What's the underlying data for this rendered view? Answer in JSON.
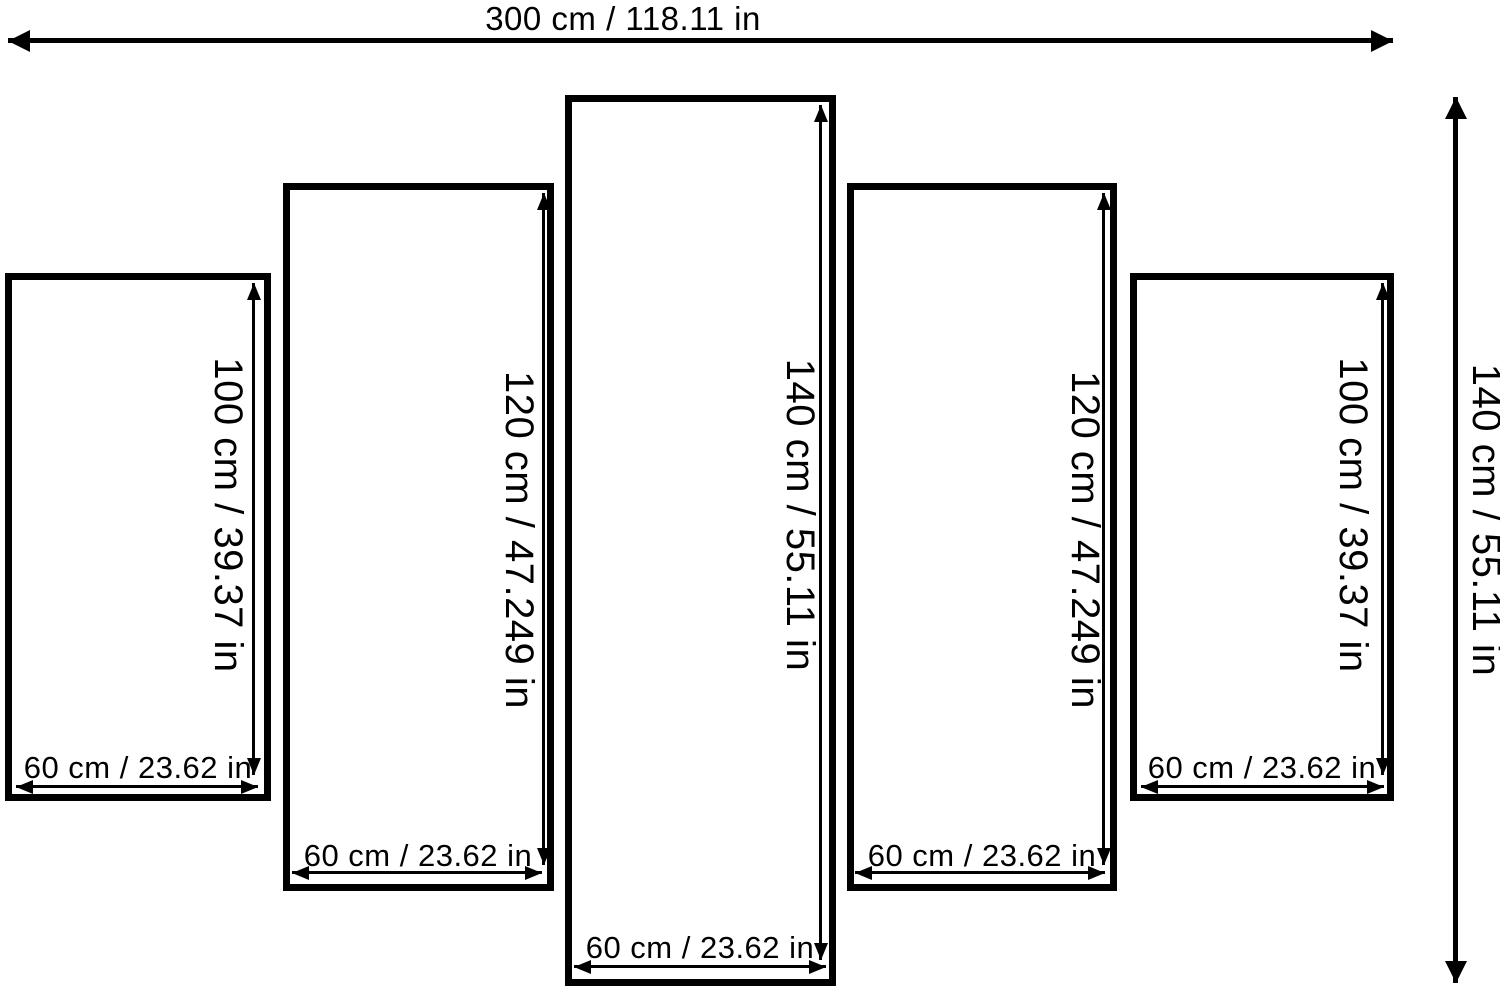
{
  "diagram": {
    "type": "five-panel canvas size diagram",
    "overall_width": {
      "label": "300 cm / 118.11 in",
      "cm": 300,
      "in": 118.11
    },
    "overall_height": {
      "label": "140 cm / 55.11 in",
      "cm": 140,
      "in": 55.11
    },
    "panels": [
      {
        "height": {
          "label": "100 cm / 39.37 in",
          "cm": 100,
          "in": 39.37
        },
        "width": {
          "label": "60 cm / 23.62 in",
          "cm": 60,
          "in": 23.62
        }
      },
      {
        "height": {
          "label": "120 cm / 47.249 in",
          "cm": 120,
          "in": 47.249
        },
        "width": {
          "label": "60 cm / 23.62 in",
          "cm": 60,
          "in": 23.62
        }
      },
      {
        "height": {
          "label": "140 cm / 55.11 in",
          "cm": 140,
          "in": 55.11
        },
        "width": {
          "label": "60 cm / 23.62 in",
          "cm": 60,
          "in": 23.62
        }
      },
      {
        "height": {
          "label": "120 cm / 47.249 in",
          "cm": 120,
          "in": 47.249
        },
        "width": {
          "label": "60 cm / 23.62 in",
          "cm": 60,
          "in": 23.62
        }
      },
      {
        "height": {
          "label": "100 cm / 39.37 in",
          "cm": 100,
          "in": 39.37
        },
        "width": {
          "label": "60 cm / 23.62 in",
          "cm": 60,
          "in": 23.62
        }
      }
    ]
  },
  "colors": {
    "line": "#000000",
    "background": "#ffffff",
    "panel_fill": "#ffffff"
  }
}
